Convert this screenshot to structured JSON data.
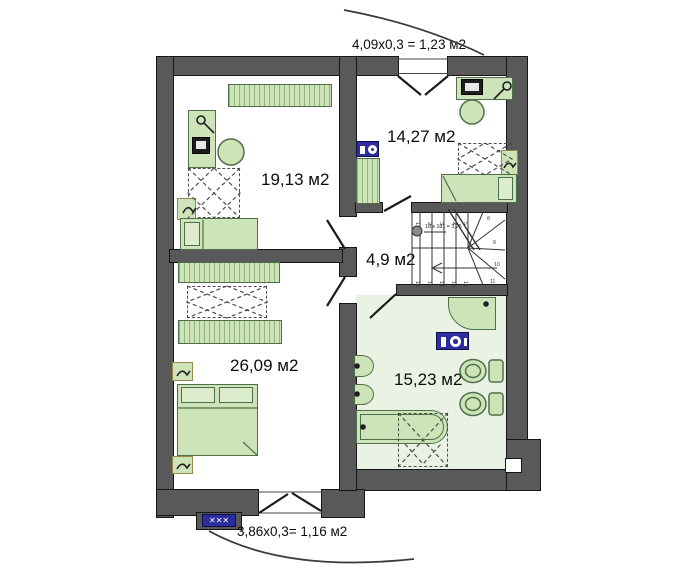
{
  "plan": {
    "rooms": [
      {
        "name": "bedroom-top-left",
        "area": "19,13 м2"
      },
      {
        "name": "bedroom-top-right",
        "area": "14,27 м2"
      },
      {
        "name": "hallway",
        "area": "4,9 м2"
      },
      {
        "name": "bedroom-bottom-left",
        "area": "26,09 м2"
      },
      {
        "name": "bathroom",
        "area": "15,23 м2"
      }
    ],
    "balcony_top_label": "4,09x0,3 = 1,23 м2",
    "balcony_bottom_label": "3,86x0,3= 1,16 м2",
    "stairs": {
      "formula": "18 x 181 = 3,25",
      "step_numbers": [
        "1",
        "2",
        "3",
        "4",
        "5",
        "8",
        "9",
        "10",
        "11",
        "12",
        "13",
        "14",
        "15",
        "16"
      ]
    },
    "radiator_glyphs": "✕✕✕",
    "colors": {
      "wall": "#595959",
      "furniture_fill": "#cde4b9",
      "furniture_border": "#4f6f4a",
      "bathroom_floor": "#e9f2e3",
      "appliance_blue": "#2d2da0"
    }
  }
}
